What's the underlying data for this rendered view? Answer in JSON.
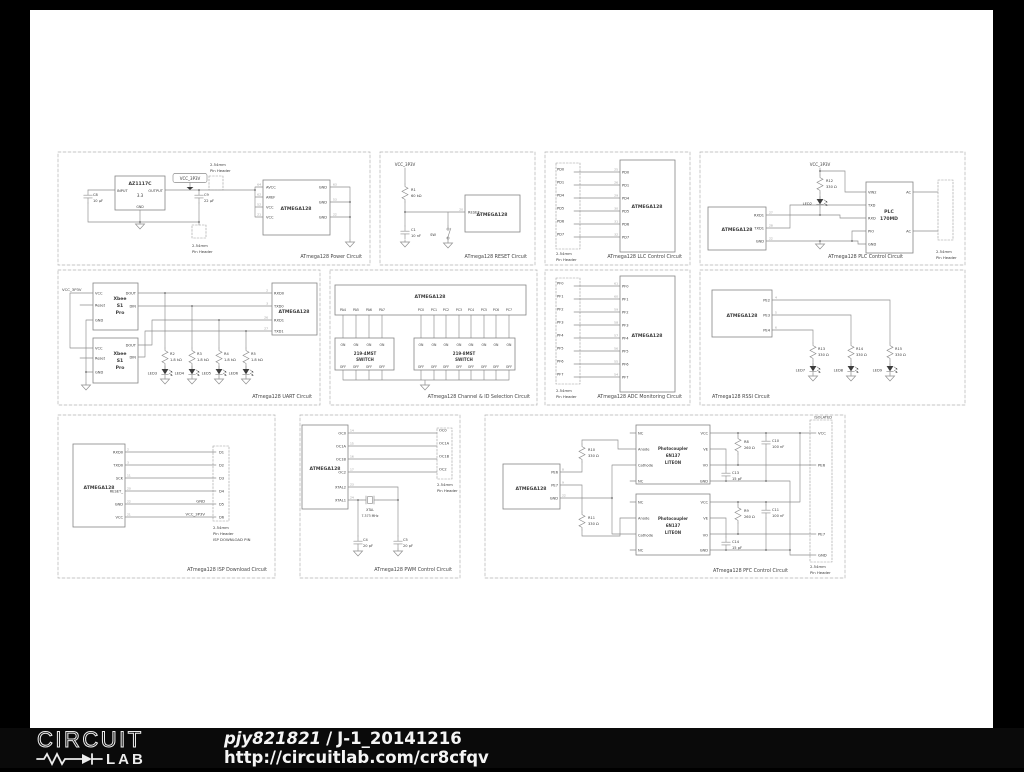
{
  "common": {
    "mcu": "ATMEGA128",
    "vcc_net": "VCC_3P3V",
    "hdr1": "2.54mm",
    "hdr2": "Pin Header",
    "on": "ON",
    "off": "OFF"
  },
  "blocks": {
    "power": {
      "title": "ATmega128 Power Circuit",
      "reg_name": "AZ1117C",
      "reg_value": "3.3",
      "reg_in": "INPUT",
      "reg_out": "OUTPUT",
      "reg_gnd": "GND",
      "c8": "C8",
      "c8_val": "10 µF",
      "c9": "C9",
      "c9_val": "22 µF",
      "left_pins": [
        "AVCC",
        "AREF",
        "VCC",
        "VCC"
      ],
      "left_nos": [
        "64",
        "62",
        "52",
        "21"
      ],
      "right_pins": [
        "GND",
        "GND",
        "GND"
      ],
      "right_nos": [
        "63",
        "53",
        "22"
      ]
    },
    "reset": {
      "title": "ATmega128 RESET Circuit",
      "r1": "R1",
      "r1_val": "60 kΩ",
      "c1": "C1",
      "c1_val": "10 nF",
      "sw": "SW",
      "pin": "RESET_",
      "pin_no": "20"
    },
    "llc": {
      "title": "ATmega128 LLC Control Circuit",
      "pins": [
        "PD0",
        "PD1",
        "PD4",
        "PD5",
        "PD6",
        "PD7"
      ],
      "nos": [
        "25",
        "26",
        "29",
        "30",
        "31",
        "32"
      ]
    },
    "plc": {
      "title": "ATmega128 PLC Control Circuit",
      "r12": "R12",
      "r12_val": "330 Ω",
      "led": "LED2",
      "mcu_pins": [
        "RXD1",
        "TXD1",
        "GND"
      ],
      "mcu_nos": [
        "27",
        "28",
        "22"
      ],
      "plc1": "PLC",
      "plc2": "170MD",
      "plc_left": [
        "VIN2",
        "TXD",
        "RXD",
        "PIO",
        "GND"
      ],
      "plc_right": [
        "AC",
        "AC"
      ]
    },
    "uart": {
      "title": "ATmega128 UART Circuit",
      "xbee1": "Xbee",
      "xbee2": "S1",
      "xbee3": "Pro",
      "xl": [
        "VCC",
        "Reset",
        "GND"
      ],
      "xr": [
        "DOUT",
        "DIN"
      ],
      "mcu_pins": [
        "RXD0",
        "TXD0",
        "RXD1",
        "TXD1"
      ],
      "mcu_nos": [
        "2",
        "3",
        "26",
        "27"
      ],
      "r": [
        [
          "R2",
          "1.8 kΩ"
        ],
        [
          "R3",
          "1.8 kΩ"
        ],
        [
          "R4",
          "1.8 kΩ"
        ],
        [
          "R5",
          "1.8 kΩ"
        ]
      ],
      "leds": [
        "LED3",
        "LED4",
        "LED5",
        "LED6"
      ]
    },
    "channel": {
      "title": "ATmega128 Channel & ID Selection Circuit",
      "pa": [
        "PA4",
        "PA5",
        "PA6",
        "PA7"
      ],
      "pc": [
        "PC0",
        "PC1",
        "PC2",
        "PC3",
        "PC4",
        "PC5",
        "PC6",
        "PC7"
      ],
      "sw4a": "219-4MST",
      "sw4b": "SWITCH",
      "sw8a": "219-8MST",
      "sw8b": "SWITCH"
    },
    "adc": {
      "title": "ATmega128 ADC Monitoring Circuit",
      "pins": [
        "PF0",
        "PF1",
        "PF2",
        "PF3",
        "PF4",
        "PF5",
        "PF6",
        "PF7"
      ],
      "nos": [
        "61",
        "60",
        "59",
        "58",
        "57",
        "56",
        "55",
        "54"
      ]
    },
    "rssi": {
      "title": "ATmega128 RSSI Circuit",
      "mcu_pins": [
        "PE2",
        "PE3",
        "PE4"
      ],
      "mcu_nos": [
        "4",
        "5",
        "6"
      ],
      "r": [
        [
          "R13",
          "330 Ω"
        ],
        [
          "R14",
          "330 Ω"
        ],
        [
          "R15",
          "330 Ω"
        ]
      ],
      "leds": [
        "LED7",
        "LED8",
        "LED9"
      ]
    },
    "isp": {
      "title": "ATmega128 ISP Download Circuit",
      "mcu_pins": [
        "RXD0",
        "TXD0",
        "SCK",
        "RESET_",
        "GND",
        "VCC"
      ],
      "mcu_nos": [
        "2",
        "3",
        "11",
        "20",
        "22",
        "21"
      ],
      "hdr_pins": [
        "D1",
        "D2",
        "D3",
        "D4",
        "D5",
        "D6"
      ],
      "gnd_net": "GND",
      "vcc_net": "VCC_3P3V",
      "hdr_cap3": "ISP DOWNLOAD PIN"
    },
    "pwm": {
      "title": "ATmega128 PWM Control Circuit",
      "mcu_pins": [
        "OC0",
        "OC1A",
        "OC1B",
        "OC2",
        "XTAL2",
        "XTAL1"
      ],
      "mcu_nos": [
        "14",
        "15",
        "16",
        "17",
        "23",
        "24"
      ],
      "hdr_pins": [
        "OC0",
        "OC1A",
        "OC1B",
        "OC2"
      ],
      "xtal": "XTAL",
      "xtal_val": "7.373 MHz",
      "c4": "C4",
      "c4_val": "20 pF",
      "c5": "C5",
      "c5_val": "20 pF"
    },
    "pfc": {
      "title": "ATmega128 PFC Control Circuit",
      "isolated": "ISOLATED",
      "mcu_pins": [
        "PE6",
        "PE7",
        "GND"
      ],
      "mcu_nos": [
        "8",
        "9",
        "22"
      ],
      "r10": "R10",
      "r10_val": "330 Ω",
      "r11": "R11",
      "r11_val": "330 Ω",
      "opto1": "Photocoupler",
      "opto2": "6N137",
      "opto3": "LITEON",
      "ol": [
        "NC",
        "Anode",
        "Cathode",
        "NC"
      ],
      "or": [
        "VCC",
        "VE",
        "VO",
        "GND"
      ],
      "r8": "R8",
      "r8_val": "260 Ω",
      "r9": "R9",
      "r9_val": "260 Ω",
      "c10": "C10",
      "c10_val": "100 nF",
      "c11": "C11",
      "c11_val": "100 nF",
      "c13": "C13",
      "c13_val": "15 pF",
      "c14": "C14",
      "c14_val": "15 pF",
      "rails": [
        "VCC",
        "PE6",
        "PE7",
        "GND"
      ]
    },
    "_captions": {}
  },
  "footer": {
    "logo_top": "CIRCUIT",
    "logo_bottom": "LAB",
    "user": "pjy821821",
    "divider": "/",
    "project": "J-1_20141216",
    "url": "http://circuitlab.com/cr8cfqv"
  }
}
